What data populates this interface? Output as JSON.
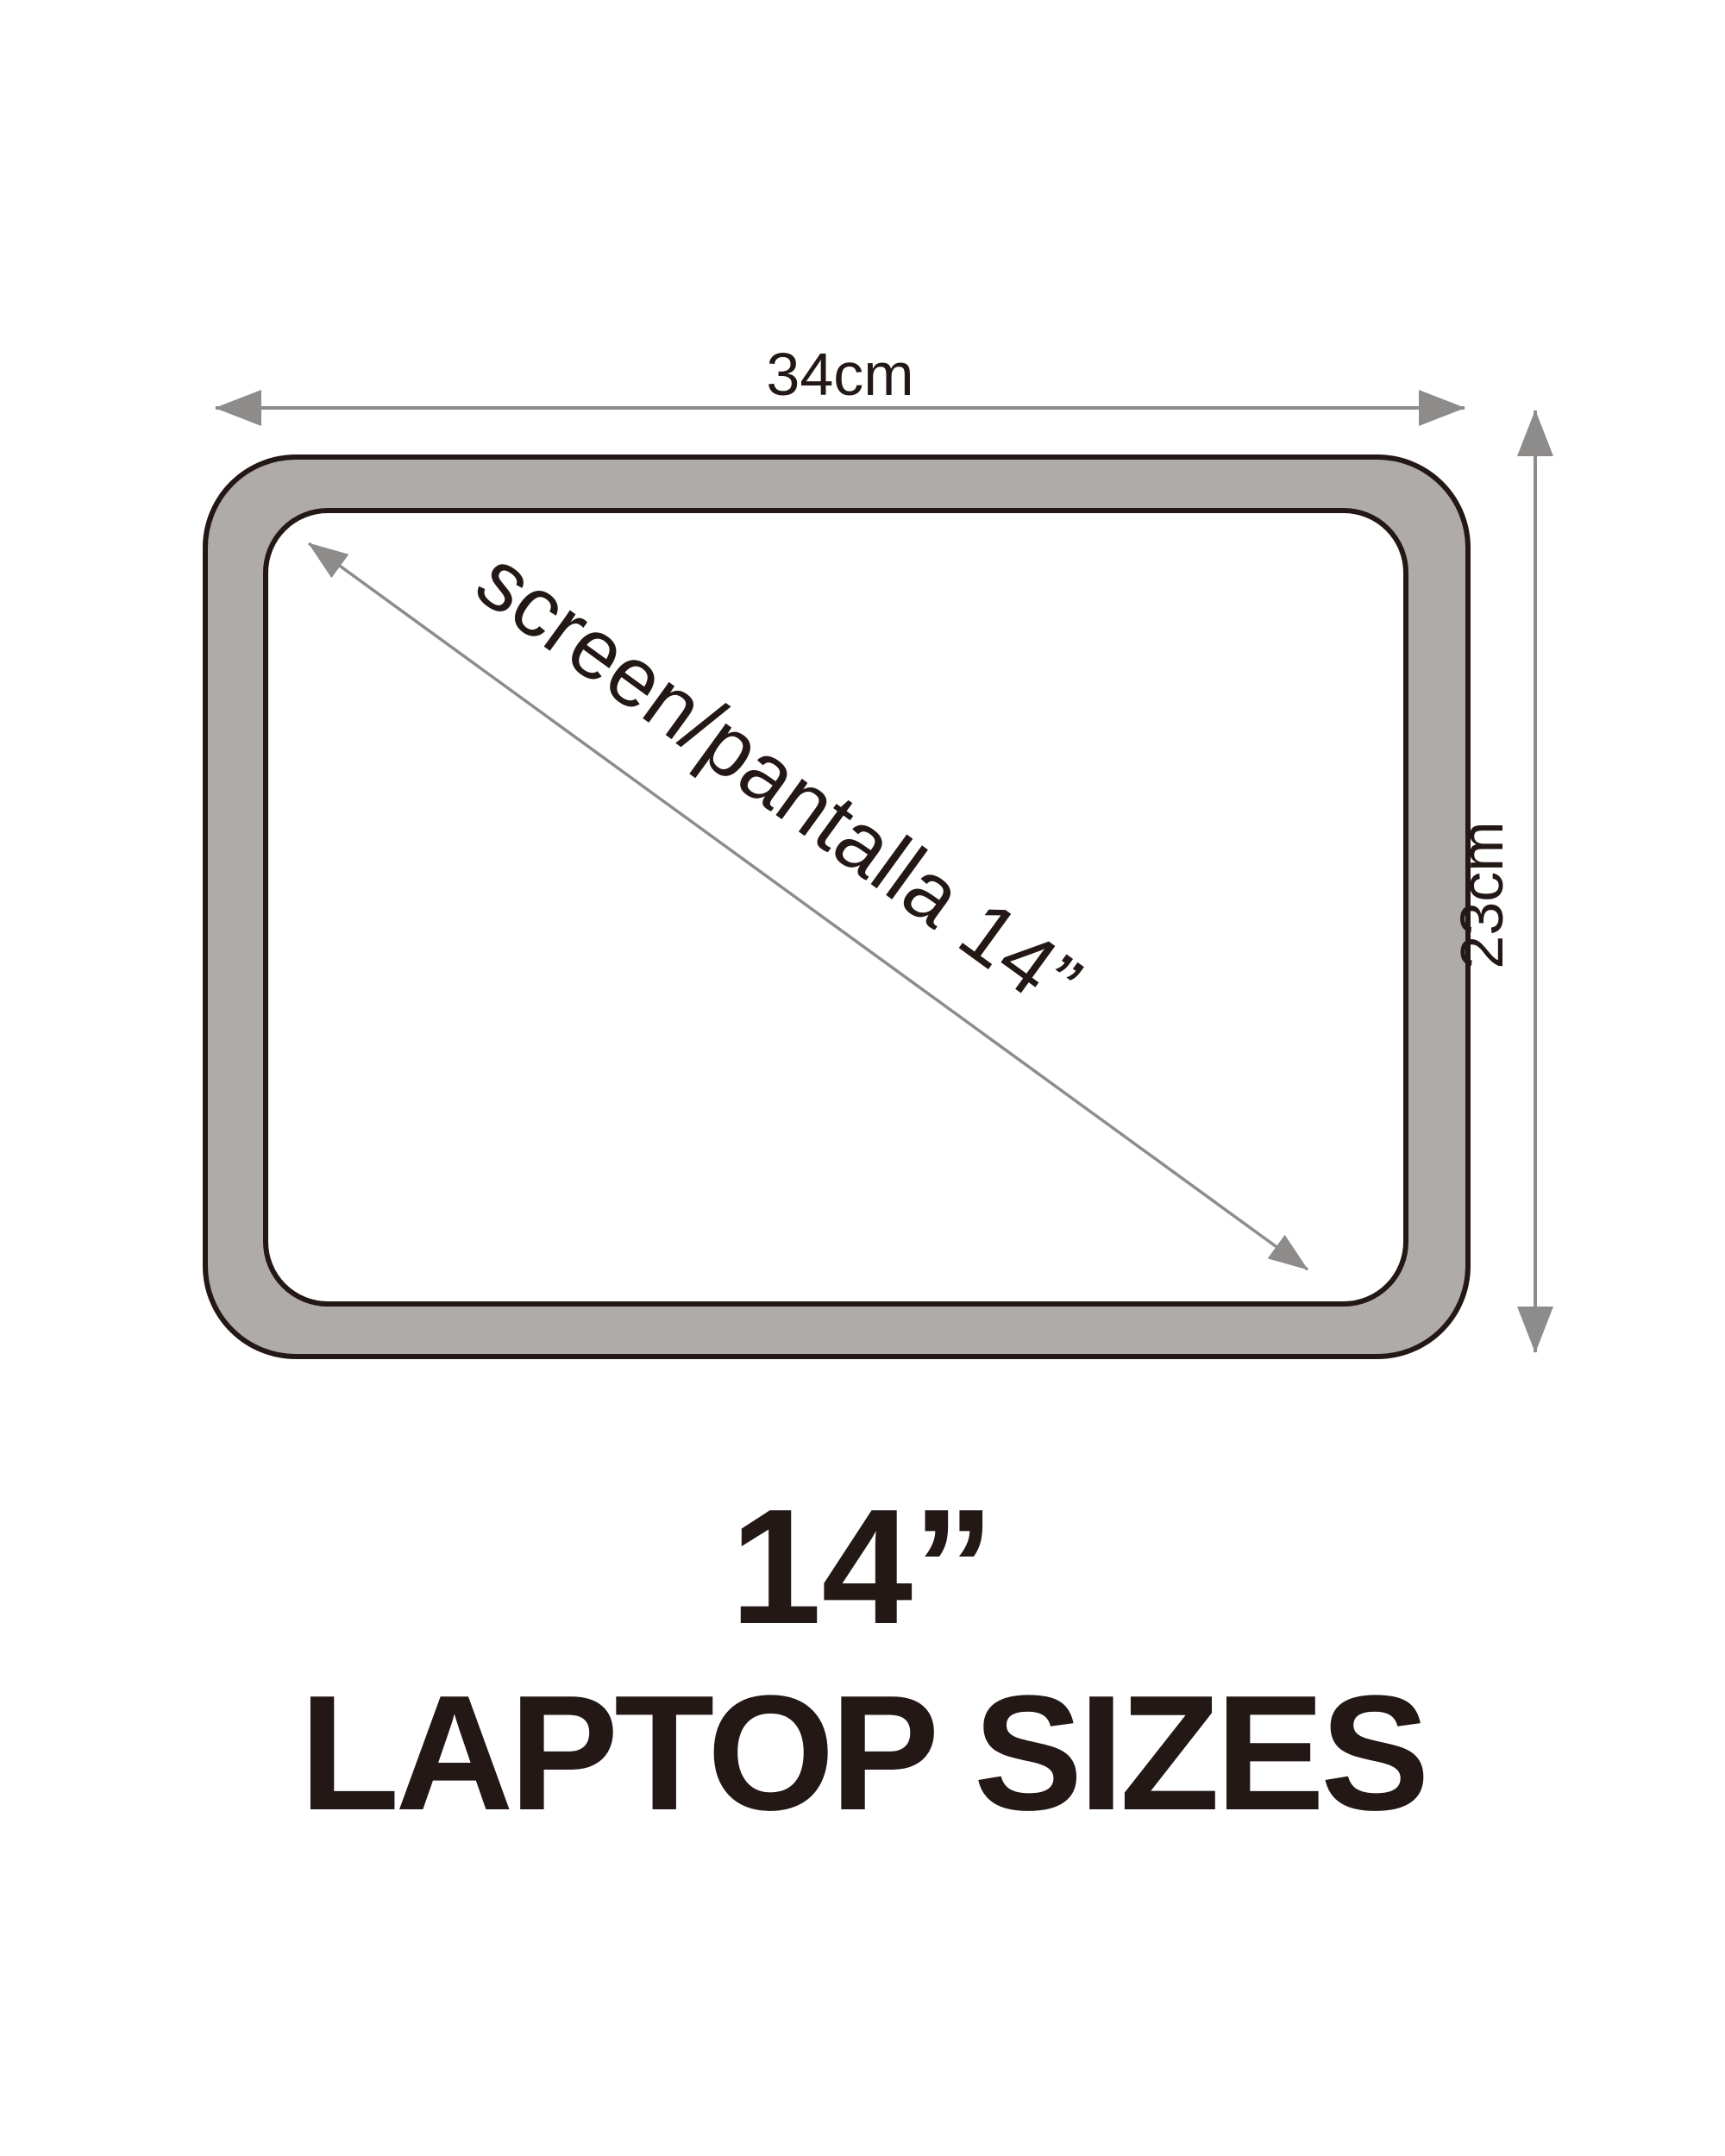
{
  "diagram": {
    "type": "laptop-size-dimension-diagram",
    "width_label": "34cm",
    "height_label": "23cm",
    "diagonal_label": "screen/pantalla 14”",
    "title_line1": "14”",
    "title_line2": "LAPTOP SIZES",
    "width_cm": 34,
    "height_cm": 23,
    "screen_inches": 14
  },
  "colors": {
    "background": "#ffffff",
    "bezel": "#b0abab",
    "screen": "#ffffff",
    "outline": "#231815",
    "arrow": "#8e8b8b",
    "text": "#231815"
  }
}
